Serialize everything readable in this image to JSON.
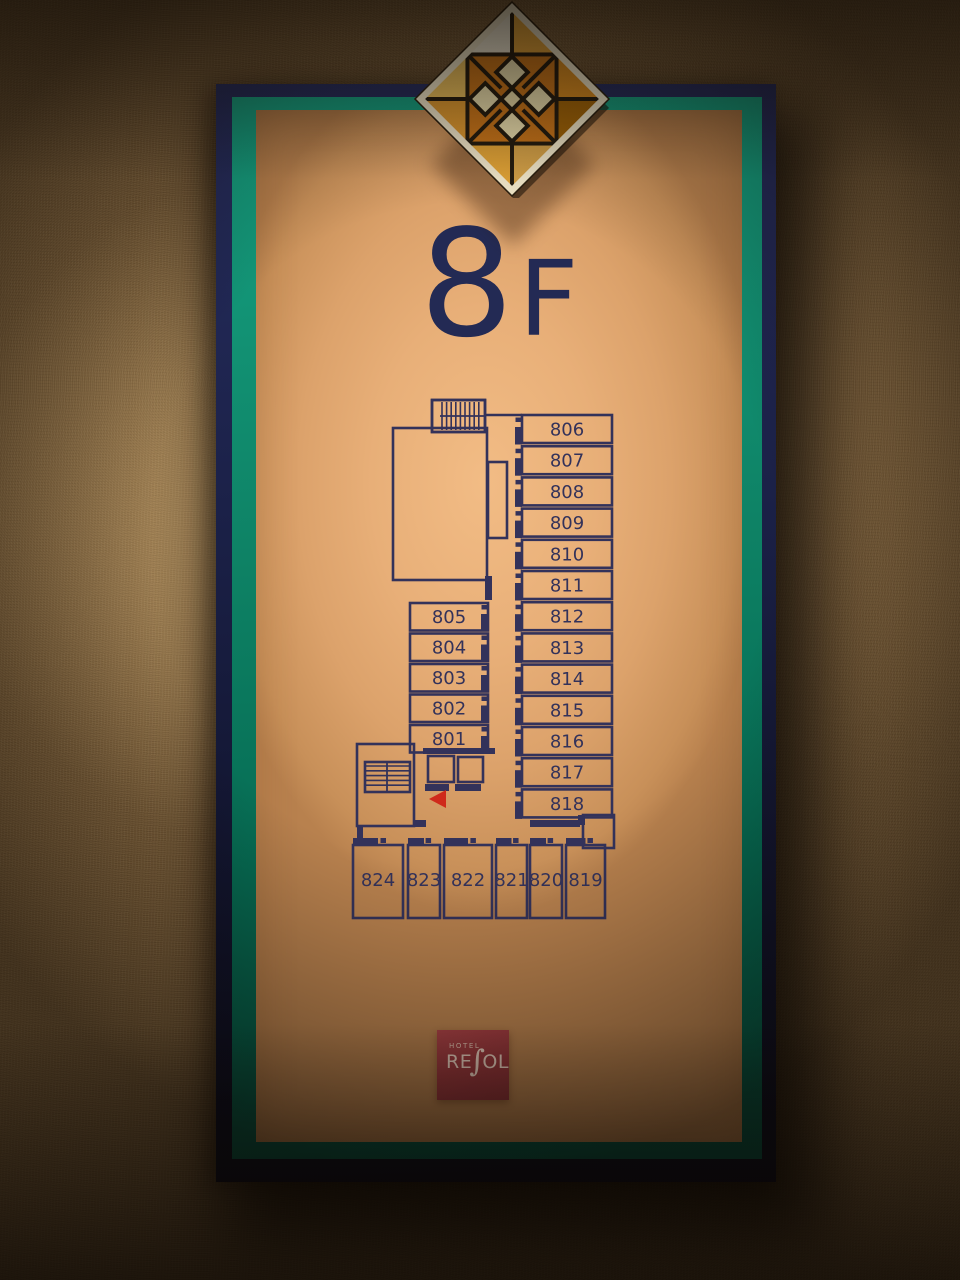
{
  "sign": {
    "floor_number": "8",
    "floor_suffix": "F",
    "logo": {
      "top": "HOTEL",
      "re": "RE",
      "s": "∫",
      "ol": "OL"
    },
    "colors": {
      "panel_face": "#e8af78",
      "frame_teal": "#0e8265",
      "frame_navy": "#1b2148",
      "plan_line": "#33325a",
      "marker_red": "#cf2a1b",
      "logo_red": "#9a373c",
      "wall": "#7d603b"
    }
  },
  "floor_plan": {
    "right_column_rooms": [
      "806",
      "807",
      "808",
      "809",
      "810",
      "811",
      "812",
      "813",
      "814",
      "815",
      "816",
      "817",
      "818"
    ],
    "left_column_rooms": [
      "805",
      "804",
      "803",
      "802",
      "801"
    ],
    "bottom_row_rooms": [
      "824",
      "823",
      "822",
      "821",
      "820",
      "819"
    ],
    "icons": {
      "stairs_top": "stairs-hatch-icon",
      "stairs_bottom": "stairs-hatch-icon",
      "elevators": "elevator-square-icon",
      "current_position": "you-are-here-triangle-icon",
      "ornament": "stained-glass-diamond-icon"
    }
  }
}
